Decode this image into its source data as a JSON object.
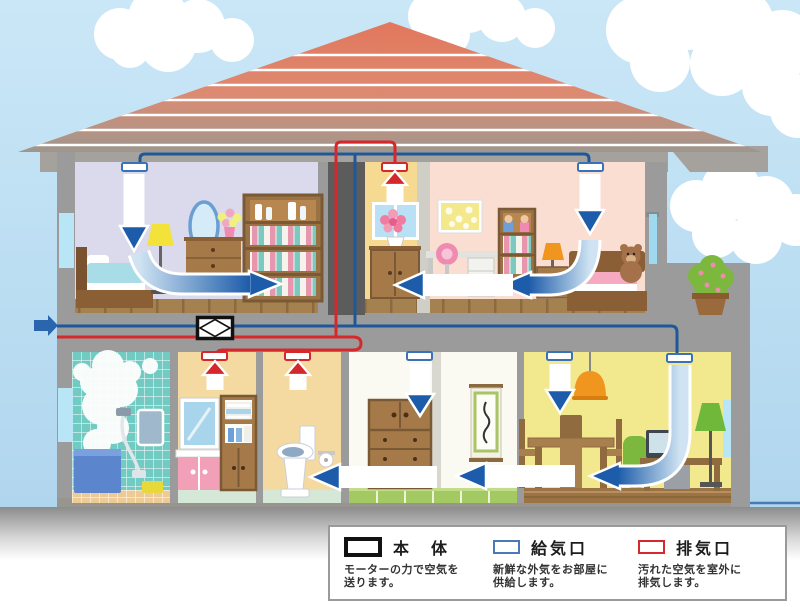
{
  "legend": {
    "items": [
      {
        "id": "main-unit",
        "label": "本　体",
        "desc1": "モーターの力で空気を",
        "desc2": "送ります。",
        "swatch_color": "#111111"
      },
      {
        "id": "supply-vent",
        "label": "給気口",
        "desc1": "新鮮な外気をお部屋に",
        "desc2": "供給します。",
        "swatch_color": "#4a7ab5"
      },
      {
        "id": "exhaust-vent",
        "label": "排気口",
        "desc1": "汚れた空気を室外に",
        "desc2": "排気します。",
        "swatch_color": "#d5282d"
      }
    ]
  },
  "colors": {
    "supply_blue": "#1d5caa",
    "exhaust_red": "#d5282d",
    "pipe_blue": "#1e5899",
    "pipe_red": "#d5282d",
    "unit_border": "#111111",
    "roof_salmon": "#e2775c",
    "sky_blue": "#c9e5f6",
    "wall_gray": "#9b9b9b"
  }
}
